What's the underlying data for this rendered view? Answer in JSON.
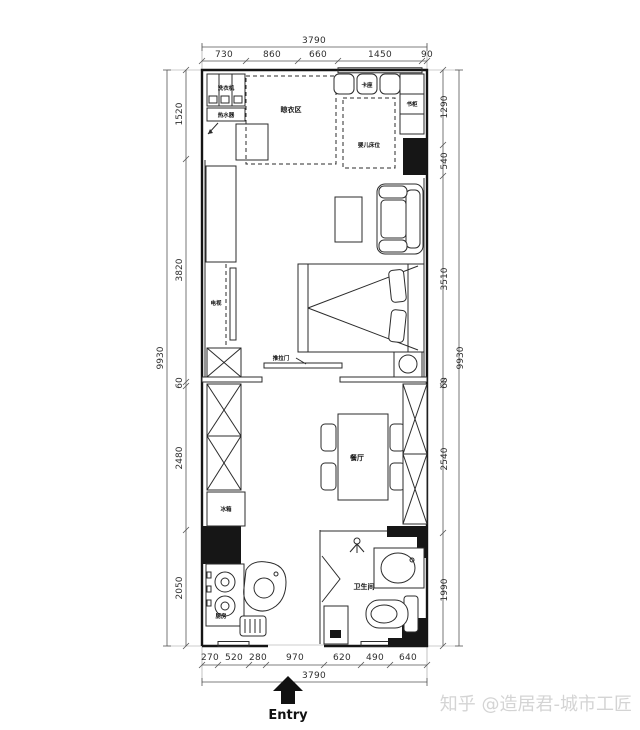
{
  "doc": {
    "type": "apartment-floor-plan"
  },
  "colors": {
    "ink": "#141414",
    "dimension_text": "#2e2e2e",
    "watermark": "#d4d4d4"
  },
  "watermark": "知乎 @造居君-城市工匠",
  "entry": {
    "label": "Entry"
  },
  "labels": {
    "washer": "洗衣机",
    "water_heater": "热水器",
    "drying_area": "晾衣区",
    "bench_seat": "卡座",
    "bookcase": "书柜",
    "baby_bed": "婴儿床位",
    "tv": "电视",
    "sliding_door": "推拉门",
    "dining": "餐厅",
    "fridge": "冰箱",
    "kitchen": "厨房",
    "bathroom": "卫生间"
  },
  "dimensions": {
    "top": {
      "total": "3790",
      "segments": [
        "730",
        "860",
        "660",
        "1450",
        "90"
      ]
    },
    "bottom": {
      "total": "3790",
      "segments": [
        "270",
        "520",
        "280",
        "970",
        "620",
        "490",
        "640"
      ]
    },
    "left": {
      "total": "9930",
      "segments": [
        "1520",
        "3820",
        "60",
        "2480",
        "2050"
      ]
    },
    "right": {
      "total": "9930",
      "segments": [
        "1290",
        "540",
        "3510",
        "60",
        "2540",
        "1990"
      ]
    }
  }
}
